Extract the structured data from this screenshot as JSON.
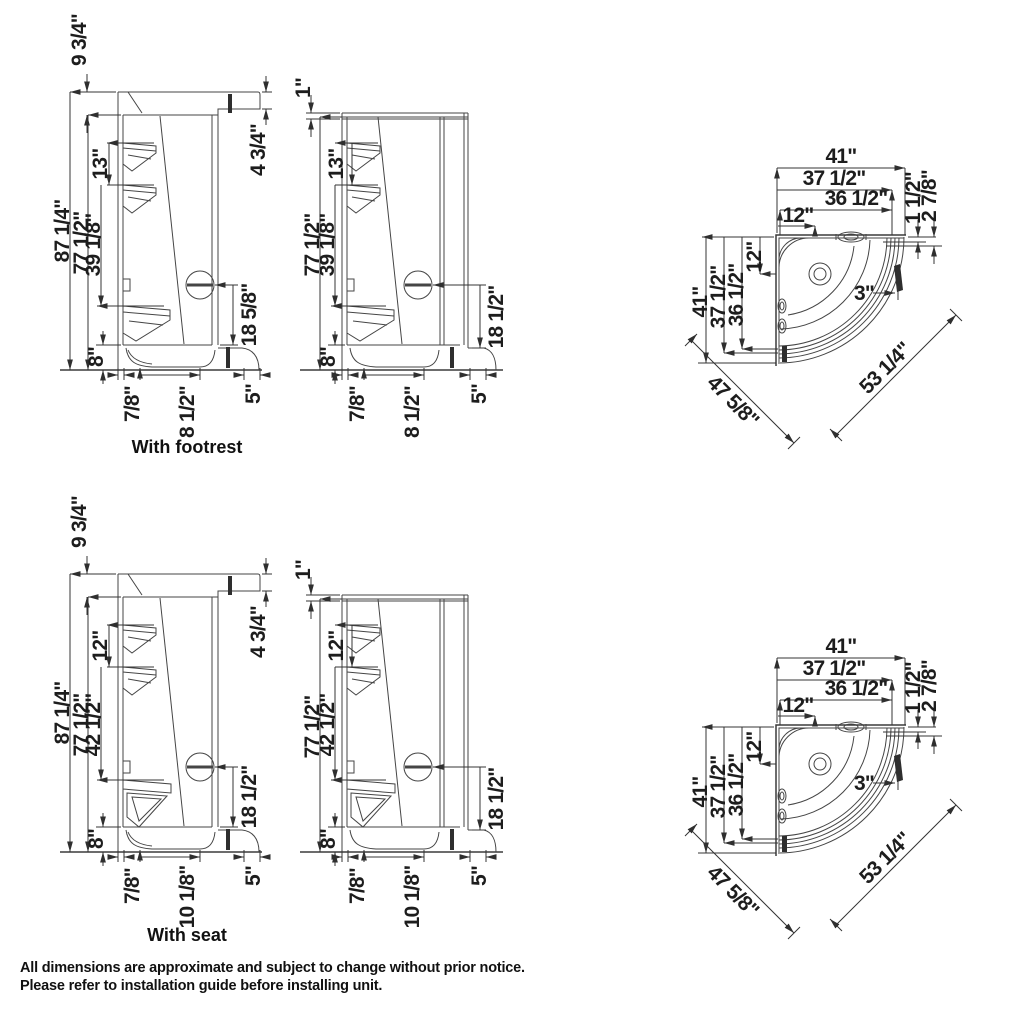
{
  "footer": {
    "line1": "All dimensions are approximate and subject to change without prior notice.",
    "line2": "Please refer to installation guide before installing unit."
  },
  "footrest": {
    "label": "With footrest",
    "capped": {
      "cap_height": "9 3/4\"",
      "total_height": "87 1/4\"",
      "wall_height": "77 1/2\"",
      "jet_spacing": "13\"",
      "jet_to_rest": "39 1/8\"",
      "base_height": "8\"",
      "cap_face_height": "4 3/4\"",
      "control_to_base": "18 5/8\"",
      "base_lip": "7/8\"",
      "rest_depth": "8 1/2\"",
      "threshold": "5\""
    },
    "open": {
      "top_trim": "1\"",
      "wall_height": "77 1/2\"",
      "jet_spacing": "13\"",
      "jet_to_rest": "39 1/8\"",
      "base_height": "8\"",
      "control_to_base": "18 1/2\"",
      "base_lip": "7/8\"",
      "rest_depth": "8 1/2\"",
      "threshold": "5\""
    }
  },
  "seat": {
    "label": "With seat",
    "capped": {
      "cap_height": "9 3/4\"",
      "total_height": "87 1/4\"",
      "wall_height": "77 1/2\"",
      "jet_spacing": "12\"",
      "jet_to_rest": "42 1/2\"",
      "base_height": "8\"",
      "cap_face_height": "4 3/4\"",
      "control_to_base": "18 1/2\"",
      "base_lip": "7/8\"",
      "rest_depth": "10 1/8\"",
      "threshold": "5\""
    },
    "open": {
      "top_trim": "1\"",
      "wall_height": "77 1/2\"",
      "jet_spacing": "12\"",
      "jet_to_rest": "42 1/2\"",
      "base_height": "8\"",
      "control_to_base": "18 1/2\"",
      "base_lip": "7/8\"",
      "rest_depth": "10 1/8\"",
      "threshold": "5\""
    }
  },
  "plan_top": {
    "width": "41\"",
    "width_mid": "37 1/2\"",
    "width_inner": "36 1/2\"",
    "corner_top": "12\"",
    "corner_side": "12\"",
    "depth": "41\"",
    "depth_mid": "37 1/2\"",
    "depth_inner": "36 1/2\"",
    "glass_offset_a": "1 1/2\"",
    "glass_offset_b": "2 7/8\"",
    "drain_offset": "3\"",
    "diag_left": "47 5/8\"",
    "diag_right": "53 1/4\""
  },
  "plan_bottom": {
    "width": "41\"",
    "width_mid": "37 1/2\"",
    "width_inner": "36 1/2\"",
    "corner_top": "12\"",
    "corner_side": "12\"",
    "depth": "41\"",
    "depth_mid": "37 1/2\"",
    "depth_inner": "36 1/2\"",
    "glass_offset_a": "1 1/2\"",
    "glass_offset_b": "2 7/8\"",
    "drain_offset": "3\"",
    "diag_left": "47 5/8\"",
    "diag_right": "53 1/4\""
  }
}
